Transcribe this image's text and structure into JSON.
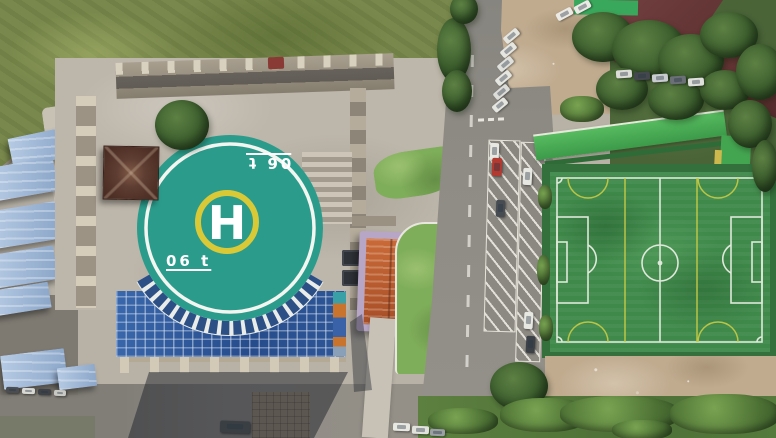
{
  "helipad": {
    "letter": "H",
    "weight_marking": "06 t",
    "pad_color": "#2b9c8c",
    "ring_color": "#f2f5f0",
    "h_ring_color": "#d9c937",
    "marking_color": "#ffffff"
  },
  "pitch": {
    "turf_color": "#3f8a4b",
    "line_color": "#dfe8da",
    "mini_field_line_color": "#c9cb45",
    "fence_color": "#33703c"
  },
  "colors": {
    "atrium_glass_roof": "#2d5494",
    "asphalt_road": "#8e8b84",
    "plaza_paving": "#bdb6aa",
    "shack_roof_blue": "#9fb9d8",
    "warehouse_roof_maroon": "#5f3232",
    "gate_roof_orange": "#c06a38",
    "gate_frame_purple": "#b7a6c6",
    "red_car": "#b23a31",
    "white_car": "#e8e8e3",
    "dark_car": "#3d4247",
    "canopy_green": "#49ae52"
  }
}
